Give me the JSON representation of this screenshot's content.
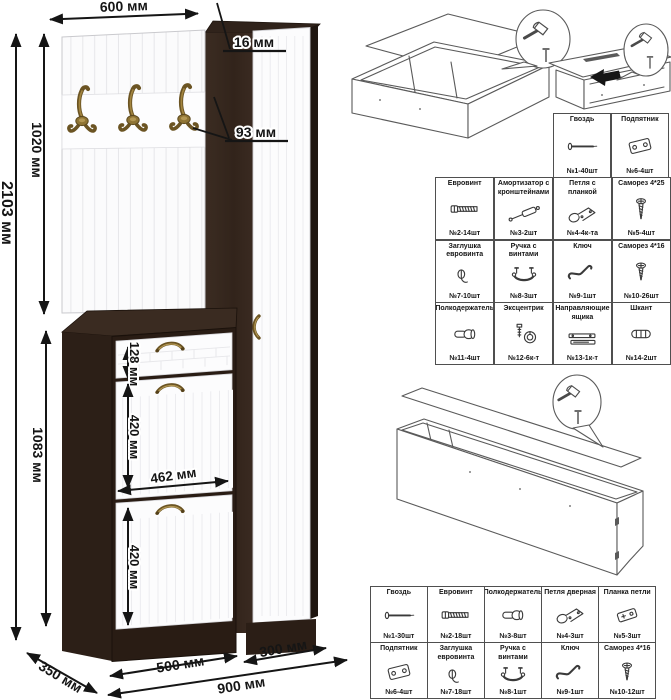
{
  "drawing": {
    "dimensions": {
      "top_width": "600 мм",
      "panel_thickness": "16 мм",
      "hook_spacing": "93 мм",
      "upper_section_height": "1020 мм",
      "total_height": "2103 мм",
      "lower_section_height": "1083 мм",
      "drawer_front_height": "128 мм",
      "upper_door_height": "420 мм",
      "inner_width": "462 мм",
      "lower_door_height": "420 мм",
      "cabinet_width": "500 мм",
      "wardrobe_width": "300 мм",
      "total_width": "900 мм",
      "depth": "350 мм"
    },
    "colors": {
      "wenge": "#32241c",
      "facade_white": "#fcfcfd",
      "brass": "#8f7434",
      "dimension_ink": "#151515"
    }
  },
  "hardware_tables": {
    "upper_small": {
      "items": [
        {
          "name": "Гвоздь",
          "count": "№1-40шт",
          "icon": "nail"
        },
        {
          "name": "Подпятник",
          "count": "№6-4шт",
          "icon": "foot-plate"
        }
      ]
    },
    "upper_main": {
      "items": [
        {
          "name": "Евровинт",
          "count": "№2-14шт",
          "icon": "euro-screw"
        },
        {
          "name": "Амортизатор с кронштейнами",
          "count": "№3-2шт",
          "icon": "gas-strut"
        },
        {
          "name": "Петля с планкой",
          "count": "№4-4к-та",
          "icon": "hinge"
        },
        {
          "name": "Саморез 4*25",
          "count": "№5-4шт",
          "icon": "screw-4x25"
        },
        {
          "name": "Заглушка евровинта",
          "count": "№7-10шт",
          "icon": "screw-cap"
        },
        {
          "name": "Ручка с винтами",
          "count": "№8-3шт",
          "icon": "handle"
        },
        {
          "name": "Ключ",
          "count": "№9-1шт",
          "icon": "hex-key"
        },
        {
          "name": "Саморез 4*16",
          "count": "№10-26шт",
          "icon": "screw-4x16"
        },
        {
          "name": "Полкодержатель",
          "count": "№11-4шт",
          "icon": "shelf-pin"
        },
        {
          "name": "Эксцентрик",
          "count": "№12-6к-т",
          "icon": "cam-lock"
        },
        {
          "name": "Направляющие ящика",
          "count": "№13-1к-т",
          "icon": "drawer-slides"
        },
        {
          "name": "Шкант",
          "count": "№14-2шт",
          "icon": "dowel"
        }
      ]
    },
    "lower_main": {
      "items": [
        {
          "name": "Гвоздь",
          "count": "№1-30шт",
          "icon": "nail"
        },
        {
          "name": "Евровинт",
          "count": "№2-18шт",
          "icon": "euro-screw"
        },
        {
          "name": "Полкодержатель",
          "count": "№3-8шт",
          "icon": "shelf-pin"
        },
        {
          "name": "Петля дверная",
          "count": "№4-3шт",
          "icon": "hinge"
        },
        {
          "name": "Планка петли",
          "count": "№5-3шт",
          "icon": "hinge-plate"
        },
        {
          "name": "Подпятник",
          "count": "№6-4шт",
          "icon": "foot-plate"
        },
        {
          "name": "Заглушка евровинта",
          "count": "№7-18шт",
          "icon": "screw-cap"
        },
        {
          "name": "Ручка с винтами",
          "count": "№8-1шт",
          "icon": "handle"
        },
        {
          "name": "Ключ",
          "count": "№9-1шт",
          "icon": "hex-key"
        },
        {
          "name": "Саморез 4*16",
          "count": "№10-12шт",
          "icon": "screw-4x16"
        }
      ]
    }
  }
}
